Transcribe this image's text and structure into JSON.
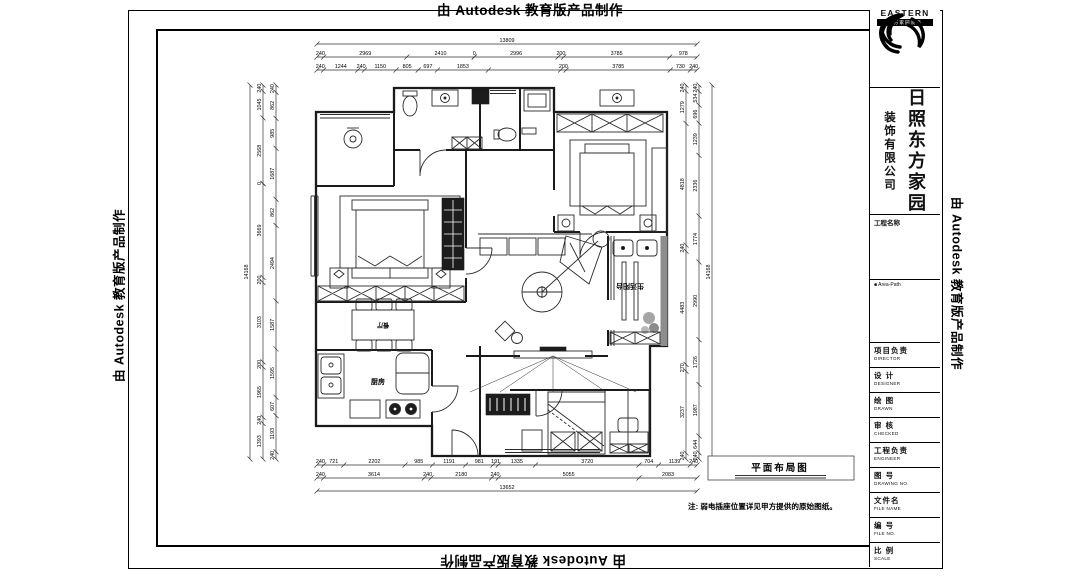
{
  "watermark": {
    "text": "由 Autodesk 教育版产品制作"
  },
  "title_block": {
    "logo": {
      "name": "EASTERN",
      "bar_text": "东方家园装饰"
    },
    "company_main": "日照东方家园",
    "company_sub": "装饰有限公司",
    "project_name_label": "工程名称",
    "area_label": "■ Area-Path",
    "fields": [
      {
        "zh": "项目负责",
        "en": "DIRECTOR"
      },
      {
        "zh": "设 计",
        "en": "DESIGNER"
      },
      {
        "zh": "绘 图",
        "en": "DRAWN"
      },
      {
        "zh": "审 核",
        "en": "CHECKED"
      },
      {
        "zh": "工程负责",
        "en": "ENGINEER"
      },
      {
        "zh": "图 号",
        "en": "DRAWING NO."
      },
      {
        "zh": "文件名",
        "en": "FILE NAME"
      },
      {
        "zh": "编 号",
        "en": "FILE NO."
      },
      {
        "zh": "比 例",
        "en": "SCALE"
      }
    ]
  },
  "drawing": {
    "title": "平面布局图",
    "note": "注: 弱电插座位置详见甲方提供的原始图纸。",
    "rooms": {
      "kitchen": "厨房",
      "dining": "餐厅",
      "balcony": "生活阳台"
    }
  },
  "dims": {
    "top_total": [
      "13809"
    ],
    "top_row2": [
      "240",
      "2969",
      "2410",
      "0",
      "2996",
      "200",
      "3785",
      "978"
    ],
    "top_row3": [
      "240",
      "1244",
      "240",
      "1150",
      "805",
      "697",
      "1853",
      "_2625",
      "200",
      "3785",
      "730",
      "240"
    ],
    "bottom_row1": [
      "240",
      "721",
      "2202",
      "985",
      "1191",
      "981",
      "191",
      "1335",
      "3720",
      "704",
      "1139",
      "240"
    ],
    "bottom_row2": [
      "240",
      "3614",
      "240",
      "2180",
      "240",
      "5055",
      "2083"
    ],
    "bottom_total": [
      "13652"
    ],
    "left_total": [
      "14168"
    ],
    "left_row2": [
      "240",
      "1045",
      "2568",
      "0",
      "3669",
      "200",
      "3103",
      "200",
      "1965",
      "240",
      "1393"
    ],
    "left_row3": [
      "240",
      "862",
      "985",
      "1687",
      "862",
      "2494",
      "1587",
      "1595",
      "607",
      "1193",
      "240"
    ],
    "right_row2": [
      "240",
      "534",
      "696",
      "1239",
      "2336",
      "1774",
      "2990",
      "1726",
      "1987",
      "644",
      "240"
    ],
    "right_row3": [
      "240",
      "1279",
      "4818",
      "240",
      "4483",
      "270",
      "3237",
      "240"
    ],
    "right_total": [
      "14168"
    ]
  }
}
